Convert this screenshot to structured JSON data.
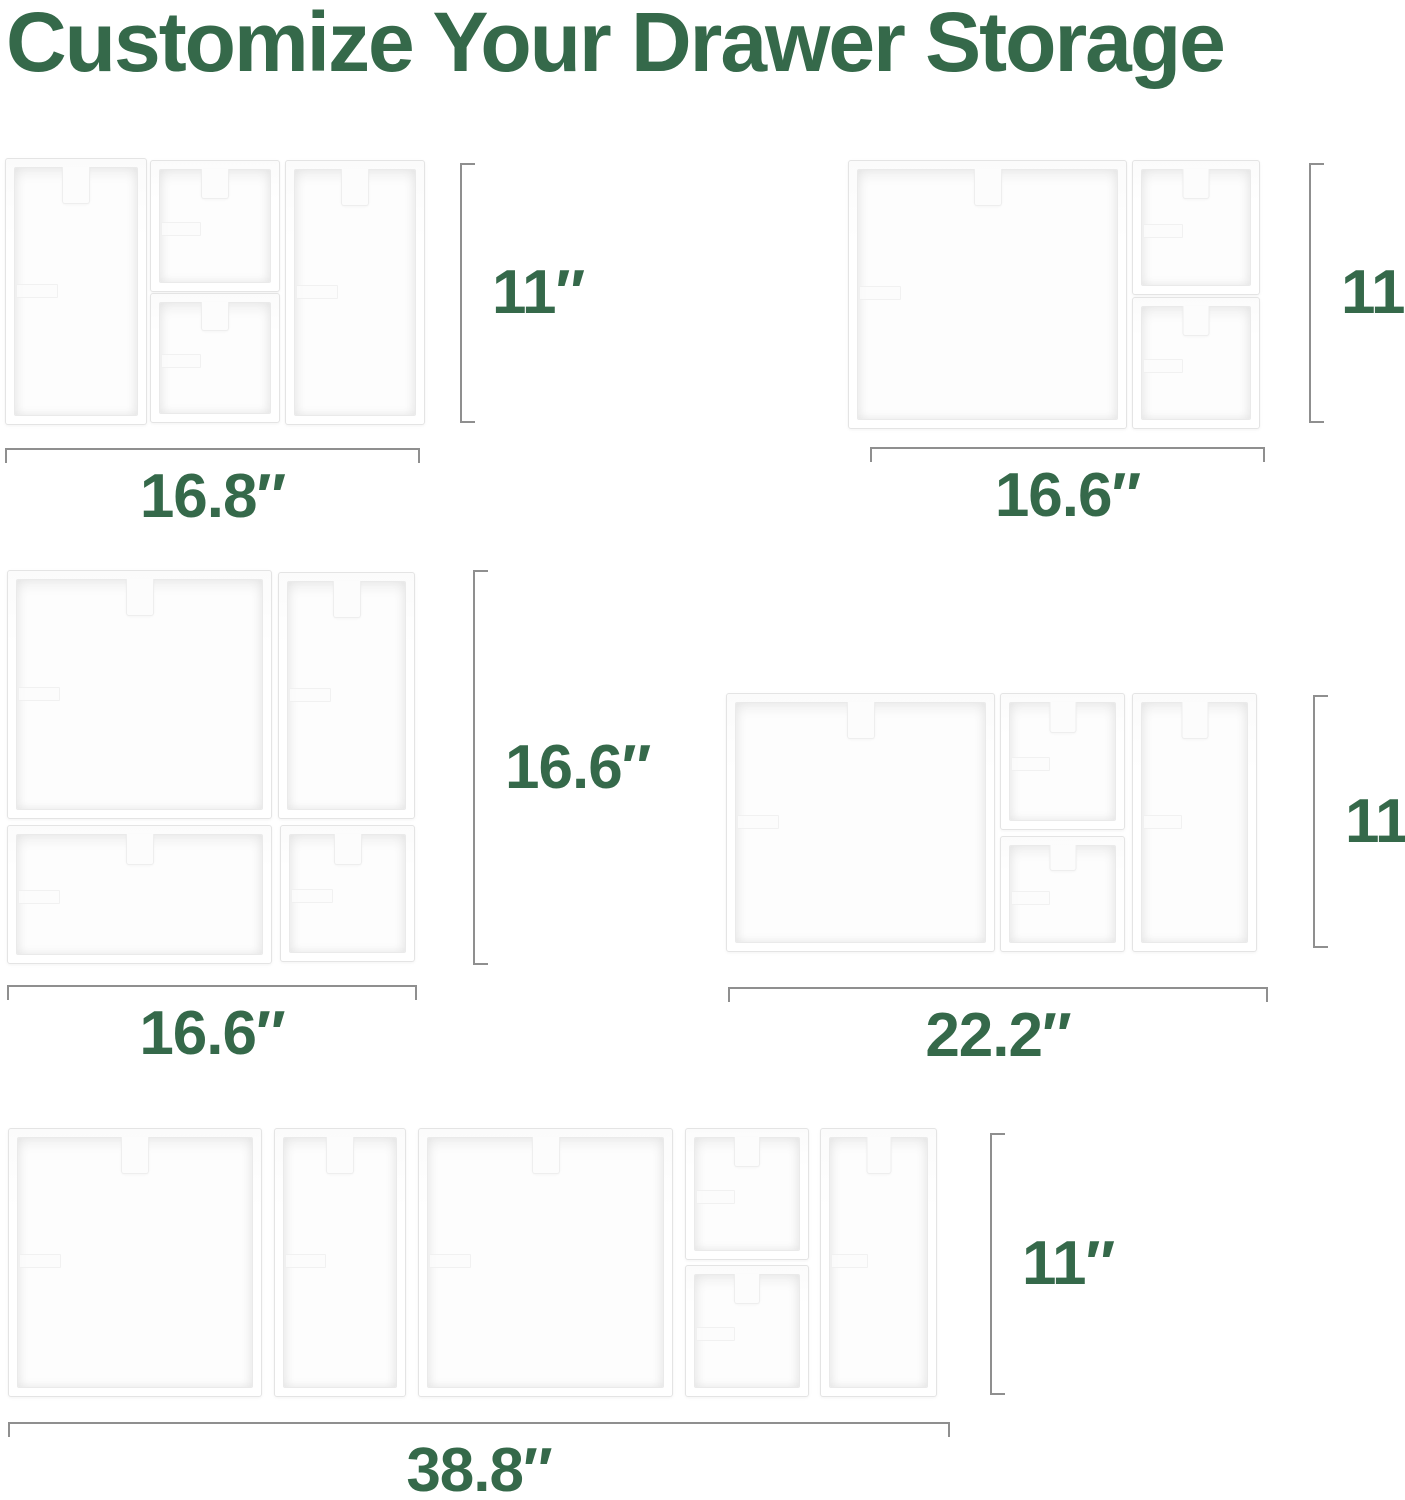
{
  "title": "Customize Your Drawer Storage",
  "colors": {
    "accent_green": "#35694a",
    "dimension_line_gray": "#8f8f8f",
    "bin_edge_gray": "#e4e4e4",
    "background": "#ffffff"
  },
  "canvas": {
    "width": 1405,
    "height": 1500
  },
  "layouts": [
    {
      "name": "organizer-set-16.8-x-11",
      "width_label": "16.8″",
      "height_label": "11″",
      "frame": {
        "x": 5,
        "y": 158,
        "w": 418,
        "h": 265
      },
      "bins": [
        {
          "x": 0,
          "y": 0,
          "w": 140,
          "h": 265
        },
        {
          "x": 145,
          "y": 2,
          "w": 128,
          "h": 130
        },
        {
          "x": 145,
          "y": 135,
          "w": 128,
          "h": 128
        },
        {
          "x": 280,
          "y": 2,
          "w": 138,
          "h": 263
        }
      ],
      "height_bracket": {
        "x": 460,
        "y1": 163,
        "y2": 423
      },
      "width_bracket": {
        "y": 448,
        "x1": 5,
        "x2": 420
      }
    },
    {
      "name": "organizer-set-16.6-x-11",
      "width_label": "16.6″",
      "height_label": "11″",
      "frame": {
        "x": 848,
        "y": 160,
        "w": 410,
        "h": 267
      },
      "bins": [
        {
          "x": 0,
          "y": 0,
          "w": 277,
          "h": 267
        },
        {
          "x": 284,
          "y": 0,
          "w": 126,
          "h": 133
        },
        {
          "x": 284,
          "y": 137,
          "w": 126,
          "h": 130
        }
      ],
      "height_bracket": {
        "x": 1309,
        "y1": 163,
        "y2": 423
      },
      "width_bracket": {
        "y": 447,
        "x1": 870,
        "x2": 1265
      }
    },
    {
      "name": "organizer-set-16.6-x-16.6",
      "width_label": "16.6″",
      "height_label": "16.6″",
      "frame": {
        "x": 7,
        "y": 570,
        "w": 406,
        "h": 392
      },
      "bins": [
        {
          "x": 0,
          "y": 0,
          "w": 263,
          "h": 247
        },
        {
          "x": 271,
          "y": 2,
          "w": 135,
          "h": 245
        },
        {
          "x": 0,
          "y": 255,
          "w": 263,
          "h": 137
        },
        {
          "x": 273,
          "y": 255,
          "w": 133,
          "h": 135
        }
      ],
      "height_bracket": {
        "x": 473,
        "y1": 570,
        "y2": 965
      },
      "width_bracket": {
        "y": 985,
        "x1": 7,
        "x2": 417
      }
    },
    {
      "name": "organizer-set-22.2-x-11",
      "width_label": "22.2″",
      "height_label": "11″",
      "frame": {
        "x": 726,
        "y": 693,
        "w": 529,
        "h": 257
      },
      "bins": [
        {
          "x": 0,
          "y": 0,
          "w": 267,
          "h": 257
        },
        {
          "x": 274,
          "y": 0,
          "w": 123,
          "h": 135
        },
        {
          "x": 274,
          "y": 143,
          "w": 123,
          "h": 114
        },
        {
          "x": 406,
          "y": 0,
          "w": 123,
          "h": 257
        }
      ],
      "height_bracket": {
        "x": 1313,
        "y1": 695,
        "y2": 948
      },
      "width_bracket": {
        "y": 987,
        "x1": 728,
        "x2": 1268
      }
    },
    {
      "name": "organizer-set-38.8-x-11",
      "width_label": "38.8″",
      "height_label": "11″",
      "frame": {
        "x": 8,
        "y": 1128,
        "w": 927,
        "h": 267
      },
      "bins": [
        {
          "x": 0,
          "y": 0,
          "w": 252,
          "h": 267
        },
        {
          "x": 266,
          "y": 0,
          "w": 130,
          "h": 267
        },
        {
          "x": 410,
          "y": 0,
          "w": 253,
          "h": 267
        },
        {
          "x": 677,
          "y": 0,
          "w": 122,
          "h": 130
        },
        {
          "x": 677,
          "y": 137,
          "w": 122,
          "h": 130
        },
        {
          "x": 812,
          "y": 0,
          "w": 115,
          "h": 267
        }
      ],
      "height_bracket": {
        "x": 990,
        "y1": 1133,
        "y2": 1395
      },
      "width_bracket": {
        "y": 1422,
        "x1": 8,
        "x2": 950
      }
    }
  ]
}
